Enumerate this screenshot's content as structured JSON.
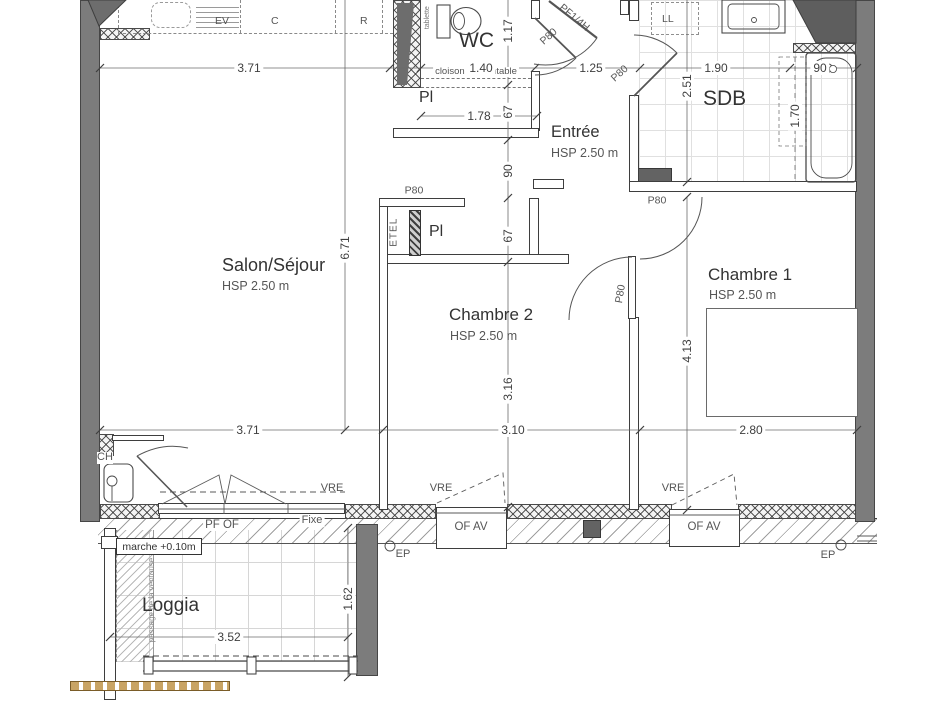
{
  "plan": {
    "rooms": {
      "salon": {
        "name": "Salon/Séjour",
        "hsp": "HSP 2.50 m"
      },
      "entree": {
        "name": "Entrée",
        "hsp": "HSP 2.50 m"
      },
      "chambre1": {
        "name": "Chambre 1",
        "hsp": "HSP 2.50 m"
      },
      "chambre2": {
        "name": "Chambre 2",
        "hsp": "HSP 2.50 m"
      },
      "sdb": {
        "name": "SDB"
      },
      "wc": {
        "name": "WC"
      },
      "loggia": {
        "name": "Loggia"
      },
      "placard1": {
        "name": "Pl"
      },
      "placard2": {
        "name": "Pl"
      },
      "etel": {
        "name": "ETEL"
      },
      "ch": {
        "name": "CH"
      }
    },
    "appliances": {
      "ev": "EV",
      "c": "C",
      "r": "R",
      "ll": "LL",
      "tablette": "tablette"
    },
    "doors": {
      "pf14h": "PF1/4H",
      "p80_wc": "P80",
      "p80_sdb": "P80",
      "p80_etel": "P80",
      "p80_ch1": "P80",
      "p80_ch2": "P80"
    },
    "windows": {
      "vre1": "VRE",
      "vre2": "VRE",
      "vre3": "VRE",
      "pf_of": "PF OF",
      "fixe": "Fixe",
      "of_av1": "OF AV",
      "of_av2": "OF AV",
      "ep1": "EP",
      "ep2": "EP"
    },
    "notes": {
      "cloison": "cloison démontable",
      "marche": "marche +0.10m",
      "ventouse": "passage de la ventouse"
    },
    "dims": {
      "top_1": "3.71",
      "top_2": "1.40",
      "top_3": "1.25",
      "top_4": "1.90",
      "top_5": "90",
      "bot_1": "3.71",
      "bot_2": "3.10",
      "bot_3": "2.80",
      "v_1": "1.17",
      "v_2": "67",
      "v_3": "90",
      "v_4": "67",
      "v_5": "3.16",
      "salon_h": "6.71",
      "sdb_h": "2.51",
      "ch1_h": "4.13",
      "bath_l": "1.70",
      "pl_w": "1.78",
      "loggia_w": "3.52",
      "loggia_d": "1.62"
    },
    "colors": {
      "wall_gray": "#7c7c7c",
      "wall_dark": "#636363",
      "line": "#3e3e3e",
      "tile": "#dedede",
      "tan": "#c9a464"
    }
  }
}
